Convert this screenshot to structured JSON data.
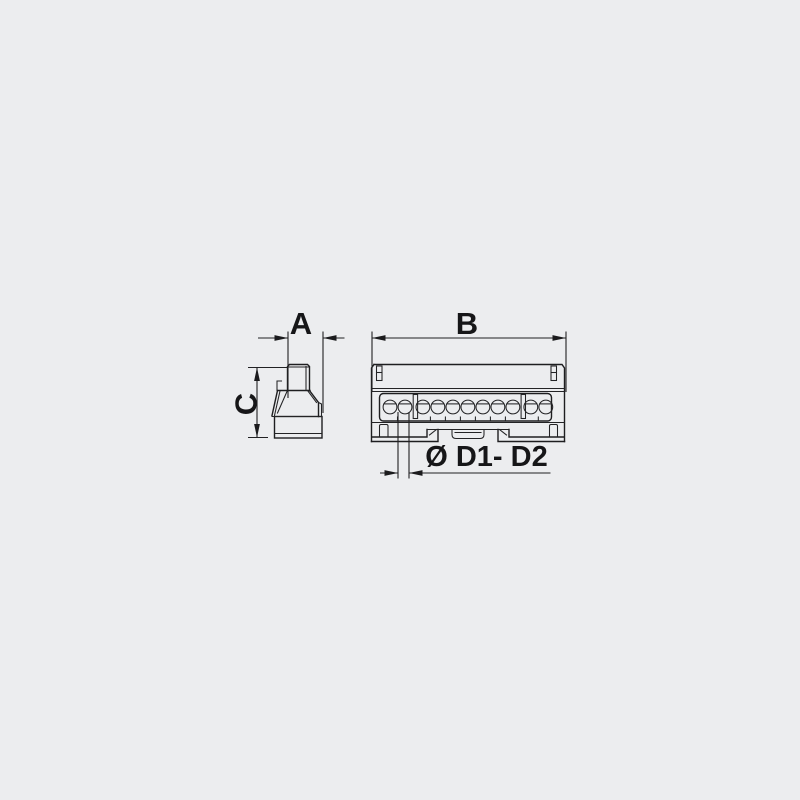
{
  "page": {
    "background_color": "#ecedef",
    "line_color": "#1e1e20",
    "text_color": "#161618"
  },
  "drawing": {
    "type": "technical-diagram",
    "subject": "terminal-block-two-view-drawing",
    "side_view": {
      "description": "tapered side profile of terminal block"
    },
    "front_view": {
      "terminal_groups": [
        2,
        7,
        2
      ],
      "terminal_total": 11
    }
  },
  "labels": {
    "dim_a": "A",
    "dim_b": "B",
    "dim_c": "C",
    "dim_d": "Ø D1- D2"
  }
}
